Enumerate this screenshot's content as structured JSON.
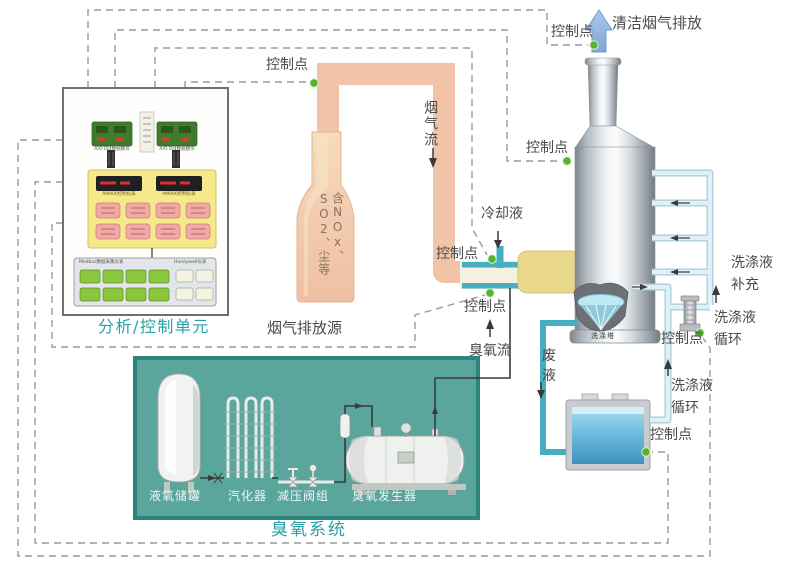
{
  "labels": {
    "control_point": "控制点",
    "clean_gas": "清洁烟气排放",
    "flue_flow": "烟气流",
    "flue_content": "含NOx、SO2、尘等",
    "flue_source": "烟气排放源",
    "analysis_unit": "分析/控制单元",
    "coolant": "冷却液",
    "ozone_flow": "臭氧流",
    "waste_liquid_1": "废",
    "waste_liquid_2": "液",
    "makeup_line1": "洗涤液",
    "makeup_line2": "补充",
    "circ_line1": "洗涤液",
    "circ_line2": "循环",
    "ozone_system": "臭氧系统",
    "lox_tank": "液氧储罐",
    "vaporizer": "汽化器",
    "valve_group": "减压阀组",
    "ozone_generator": "臭氧发生器",
    "scrub_tower": "洗涤塔"
  },
  "analysis_unit_internals": {
    "module_left_caption": "A/O DI4数据模块",
    "module_right_caption": "A/O DI4数据模块",
    "display_left_caption": "AM900控制仪表",
    "display_right_caption": "AM900控制仪表",
    "io_panel_caption": "Modbus数据采集仪表",
    "io_panel_caption_right": "Honeywell仪表"
  },
  "colors": {
    "pipe_salmon": "#f1c3a7",
    "duct_yellow": "#e9d78c",
    "teal_pipe": "#45aec0",
    "light_blue_pipe": "#dff0f7",
    "ozone_box": "#5aa69c",
    "ozone_box_border": "#2e857b",
    "accent_teal": "#2aa0a6",
    "control_dot": "#55b42d",
    "clean_gas_arrow": "#8fb3dc",
    "dashed_line": "#9a9a9a"
  }
}
